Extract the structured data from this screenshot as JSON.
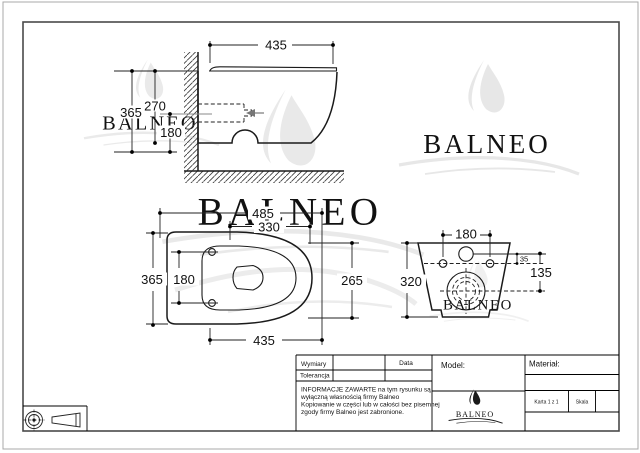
{
  "brand_text": "BALNEO",
  "dims": {
    "side": {
      "top_width": "435",
      "height": "365",
      "upper": "270",
      "lower": "180"
    },
    "plan": {
      "overall_width": "485",
      "seat_width": "330",
      "depth": "365",
      "hole_spacing": "180",
      "inner_depth": "265",
      "bottom_width": "435"
    },
    "front": {
      "hole_spacing": "180",
      "height": "320",
      "inlet_to_holes": "35",
      "inlet_to_drain": "135"
    }
  },
  "title_block": {
    "wymiary_label": "Wymiary",
    "tolerancja_label": "Tolerancja",
    "data_label": "Data",
    "model_label": "Model:",
    "material_label": "Materiał:",
    "karta_label": "Karta 1 z 1",
    "skala_label": "Skala",
    "info_lines": [
      "INFORMACJE ZAWARTE na tym rysunku są",
      "wyłączną własnością firmy Balneo",
      "Kopiowanie w części lub w całości bez pisemnej",
      "zgody firmy Balneo jest zabronione."
    ]
  },
  "colors": {
    "line": "#1a1a1a",
    "frame": "#4a4a4a",
    "watermark": "#e9e9e9",
    "page_edge": "#a8a8a8"
  }
}
